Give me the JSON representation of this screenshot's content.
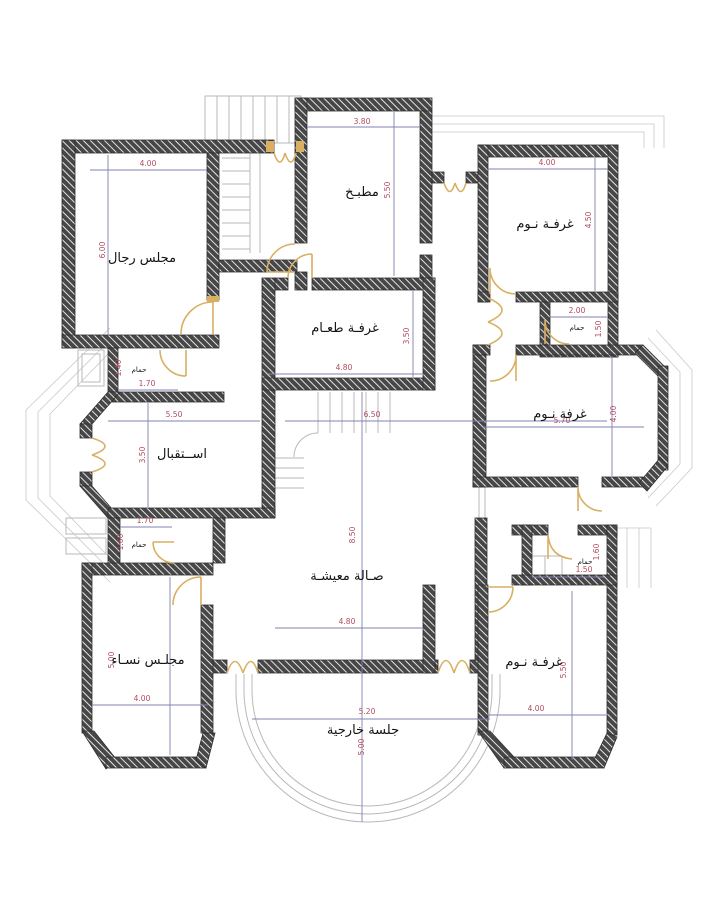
{
  "document": {
    "type": "floor-plan",
    "language": "ar"
  },
  "colors": {
    "background": "#ffffff",
    "wall_fill": "#474747",
    "wall_hatch": "#ffffff",
    "door": "#d9af62",
    "dimension_line": "#8181b0",
    "dimension_text": "#b24a5e",
    "label_text": "#141414",
    "thin_outline": "#b9b9b9"
  },
  "rooms": {
    "majlis_rijal": {
      "label": "مجلس رجال",
      "w": "4.00",
      "h": "6.00"
    },
    "matbakh": {
      "label": "مطبـخ",
      "w": "3.80",
      "h": "5.50"
    },
    "bedroom_tr": {
      "label": "غرفـة نـوم",
      "w": "4.00",
      "h": "4.50"
    },
    "bath_tr": {
      "label": "حمام",
      "w": "2.00",
      "h": "1.50"
    },
    "dining": {
      "label": "غرفـة طعـام",
      "w": "4.80",
      "h": "3.50"
    },
    "bedroom_mr": {
      "label": "غرفة نـوم",
      "w": "5.70",
      "h": "4.00"
    },
    "reception": {
      "label": "اســتقبال",
      "w": "5.50",
      "h": "3.50"
    },
    "bath_tl": {
      "label": "حمام",
      "w": "1.70",
      "h": "1.40"
    },
    "bath_rec": {
      "label": "حمام",
      "w": "1.70",
      "h": "1.60"
    },
    "hall": {
      "label": "صـالة معيشـة",
      "w": "4.80",
      "h": "8.50",
      "corridor": "6.50"
    },
    "majlis_nisa": {
      "label": "مجلـس نسـاء",
      "w": "4.00",
      "h": "5.00"
    },
    "bath_br": {
      "label": "حمام",
      "w": "1.50",
      "h": "1.60"
    },
    "bedroom_br": {
      "label": "غرفـة نـوم",
      "w": "4.00",
      "h": "5.50"
    },
    "outdoor": {
      "label": "جلسة خارجية",
      "w": "5.20",
      "h": "5.00"
    }
  }
}
